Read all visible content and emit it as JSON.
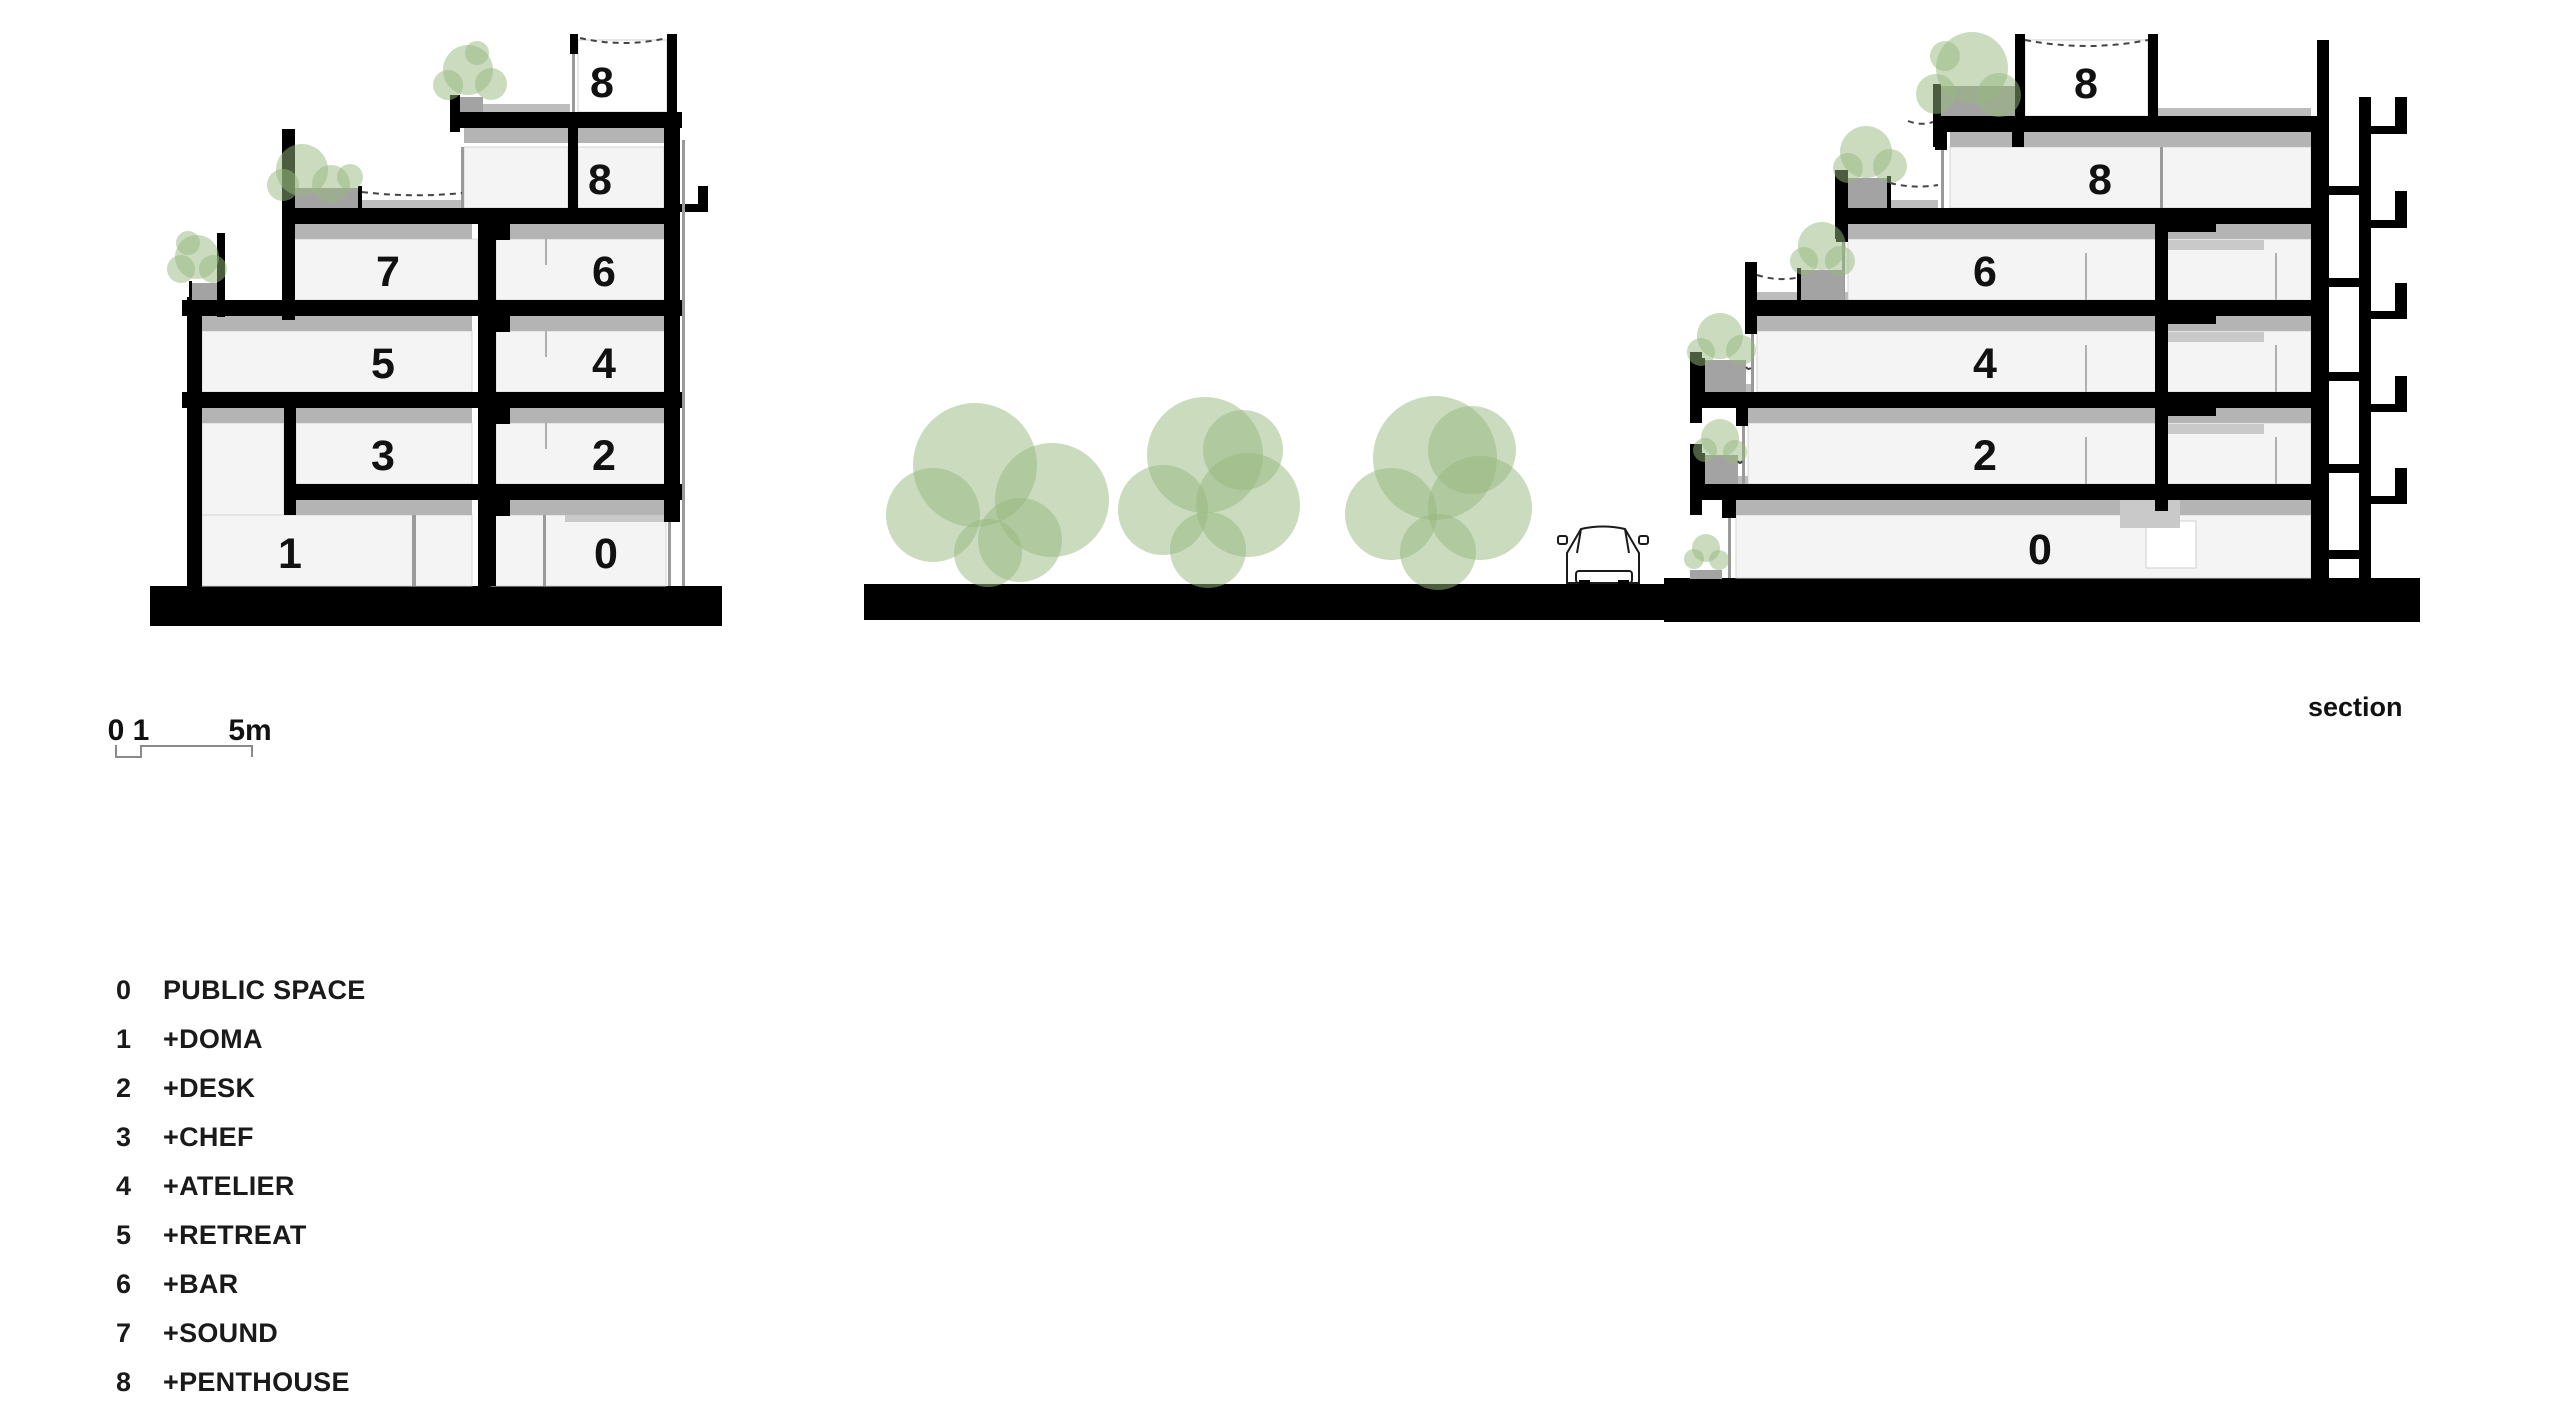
{
  "annotations": {
    "section_label": "section"
  },
  "scale_bar": {
    "zero": "0",
    "one": "1",
    "five": "5m"
  },
  "left_building": {
    "bay_a": [
      "1",
      "3",
      "5",
      "7"
    ],
    "bay_b": [
      "0",
      "2",
      "4",
      "6",
      "8",
      "8"
    ]
  },
  "right_building": {
    "floors": [
      "0",
      "2",
      "4",
      "6",
      "8",
      "8"
    ]
  },
  "legend": {
    "items": [
      {
        "num": "0",
        "label": "PUBLIC SPACE"
      },
      {
        "num": "1",
        "label": "+DOMA"
      },
      {
        "num": "2",
        "label": "+DESK"
      },
      {
        "num": "3",
        "label": "+CHEF"
      },
      {
        "num": "4",
        "label": "+ATELIER"
      },
      {
        "num": "5",
        "label": "+RETREAT"
      },
      {
        "num": "6",
        "label": "+BAR"
      },
      {
        "num": "7",
        "label": "+SOUND"
      },
      {
        "num": "8",
        "label": "+PENTHOUSE"
      }
    ]
  },
  "colors": {
    "tree_green": "#96b77e",
    "structure_black": "#000000",
    "slab_grey": "#b4b4b4",
    "room_fill": "#f4f4f4"
  }
}
